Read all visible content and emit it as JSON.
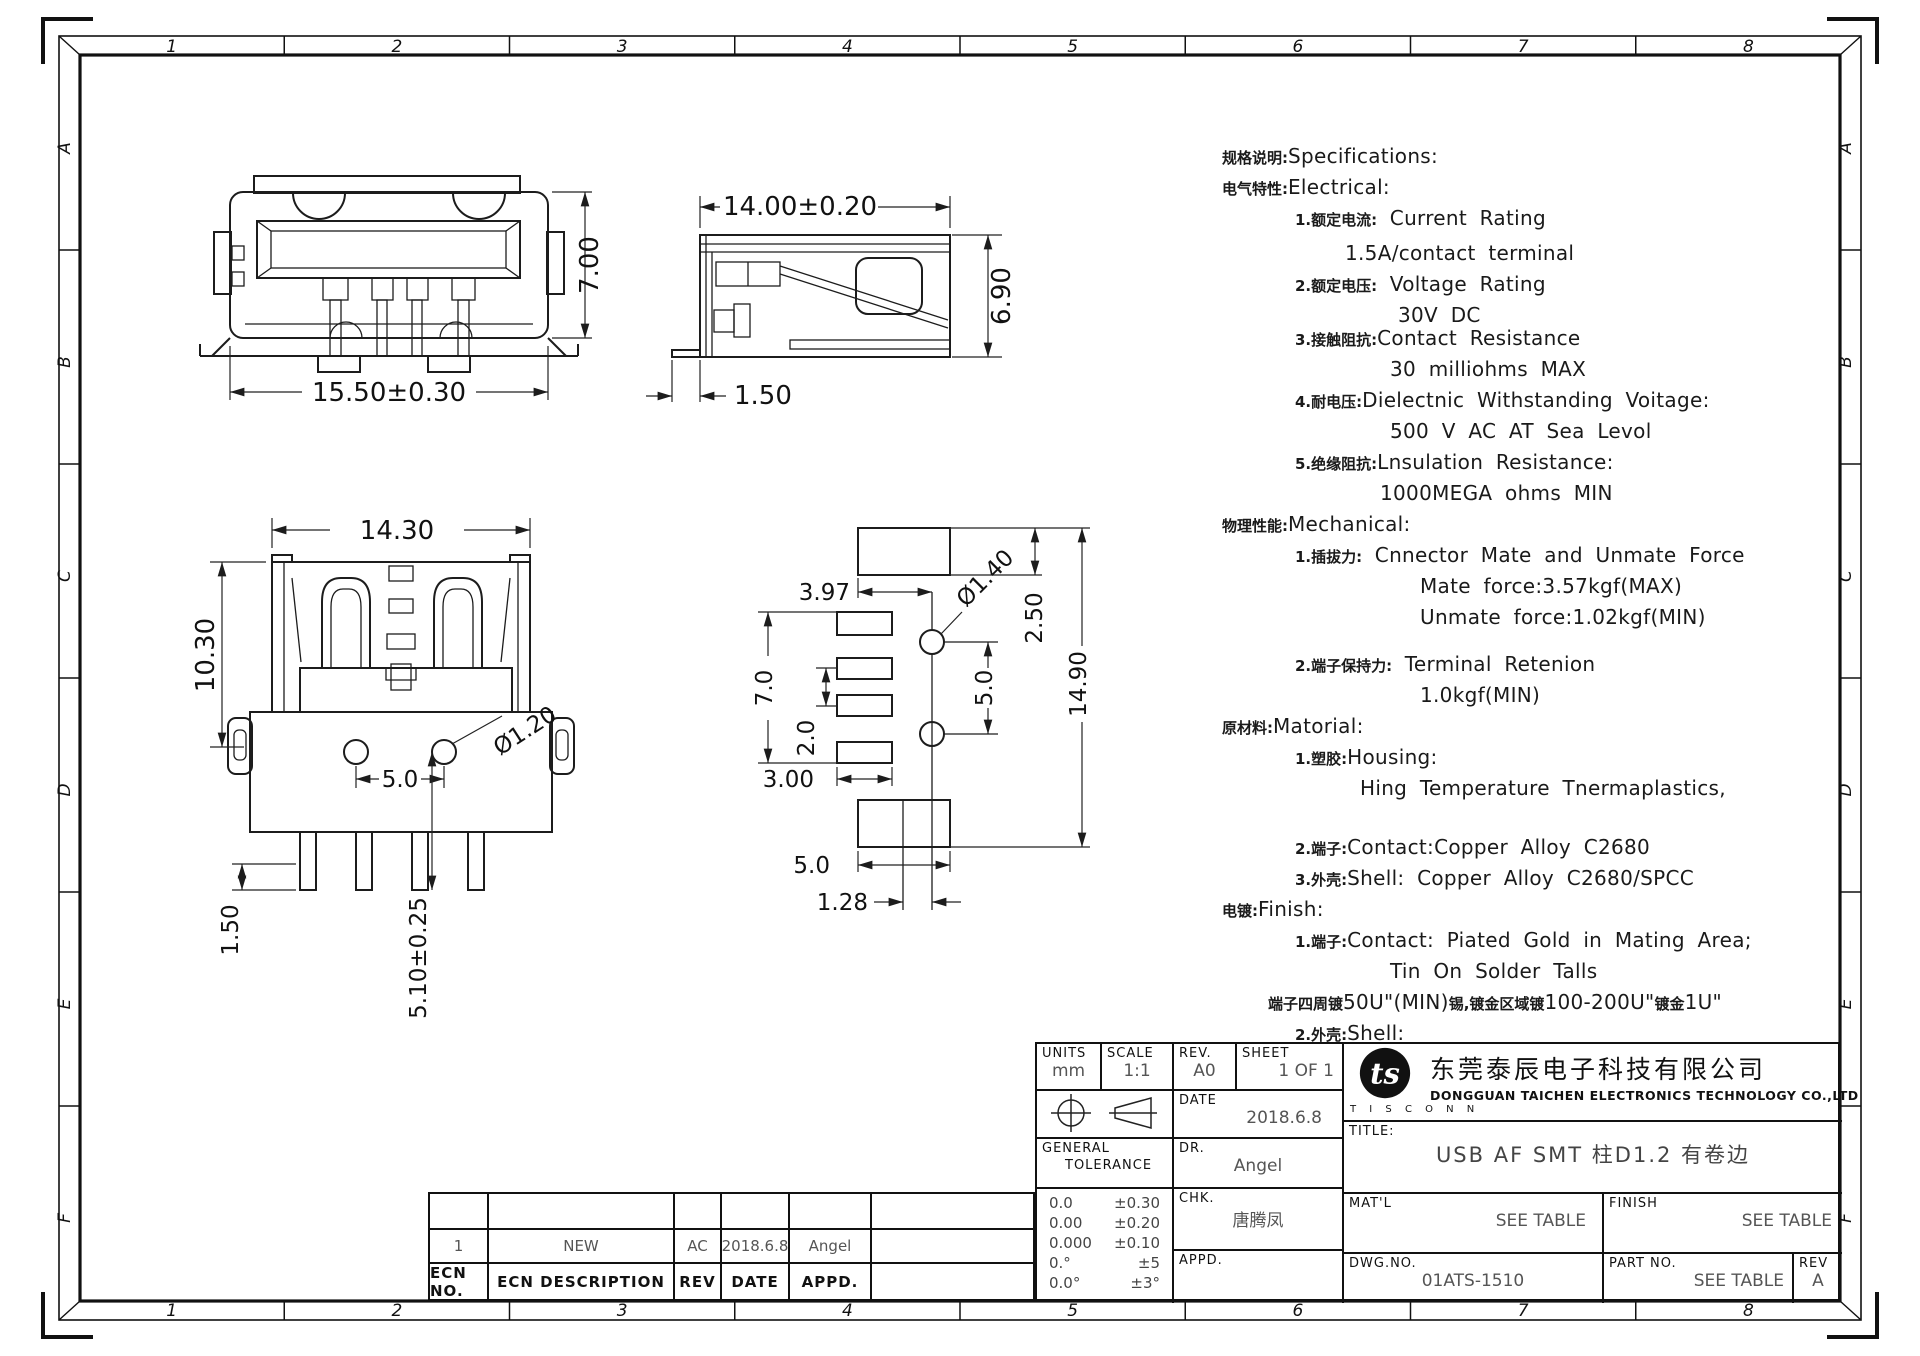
{
  "border": {
    "cols": [
      "1",
      "2",
      "3",
      "4",
      "5",
      "6",
      "7",
      "8"
    ],
    "rows": [
      "A",
      "B",
      "C",
      "D",
      "E",
      "F"
    ]
  },
  "views": {
    "front": {
      "width": "15.50±0.30",
      "height": "7.00"
    },
    "side": {
      "width": "14.00±0.20",
      "height": "6.90",
      "foot": "1.50"
    },
    "bottom": {
      "width": "14.30",
      "height": "10.30",
      "hole": "Ø1.20",
      "pitch": "5.0",
      "leg": "1.50",
      "depth": "5.10±0.25"
    },
    "footprint": {
      "pad_offset": "3.97",
      "pads_span": "7.0",
      "pad_pitch": "2.0",
      "pad_width": "3.00",
      "hole": "Ø1.40",
      "pad_height": "2.50",
      "hole_pitch": "5.0",
      "total_height": "14.90",
      "pad2_width": "5.0",
      "center_offset": "1.28"
    }
  },
  "specs": {
    "lines": [
      {
        "segs": [
          [
            "zh",
            "规格说明:"
          ],
          [
            "en",
            "Specifications:"
          ]
        ],
        "indent": 0,
        "gap": 0
      },
      {
        "segs": [
          [
            "zh",
            "电气特性:"
          ],
          [
            "en",
            "Electrical:"
          ]
        ],
        "indent": 0,
        "gap": 0
      },
      {
        "segs": [
          [
            "zh",
            "1.额定电流:"
          ],
          [
            "en",
            " Current Rating"
          ]
        ],
        "indent": 73,
        "gap": 0
      },
      {
        "segs": [
          [
            "en",
            "1.5A/contact terminal"
          ]
        ],
        "indent": 123,
        "gap": 4
      },
      {
        "segs": [
          [
            "zh",
            "2.额定电压:"
          ],
          [
            "en",
            " Voltage Rating"
          ]
        ],
        "indent": 73,
        "gap": 0
      },
      {
        "segs": [
          [
            "en",
            "30V DC"
          ]
        ],
        "indent": 176,
        "gap": 0
      },
      {
        "segs": [
          [
            "zh",
            "3.接触阻抗:"
          ],
          [
            "en",
            "Contact Resistance"
          ]
        ],
        "indent": 73,
        "gap": -8
      },
      {
        "segs": [
          [
            "en",
            "30 milliohms MAX"
          ]
        ],
        "indent": 168,
        "gap": 0
      },
      {
        "segs": [
          [
            "zh",
            "4.耐电压:"
          ],
          [
            "en",
            "Dielectnic Withstanding Voitage:"
          ]
        ],
        "indent": 73,
        "gap": 0
      },
      {
        "segs": [
          [
            "en",
            "500 V AC AT Sea Levol"
          ]
        ],
        "indent": 168,
        "gap": 0
      },
      {
        "segs": [
          [
            "zh",
            "5.绝缘阻抗:"
          ],
          [
            "en",
            "Lnsulation Resistance:"
          ]
        ],
        "indent": 73,
        "gap": 0
      },
      {
        "segs": [
          [
            "en",
            "1000MEGA ohms MIN"
          ]
        ],
        "indent": 158,
        "gap": 0
      },
      {
        "segs": [
          [
            "zh",
            "物理性能:"
          ],
          [
            "en",
            "Mechanical:"
          ]
        ],
        "indent": 0,
        "gap": 0
      },
      {
        "segs": [
          [
            "zh",
            "1.插拔力:"
          ],
          [
            "en",
            " Cnnector Mate and Unmate Force"
          ]
        ],
        "indent": 73,
        "gap": 0
      },
      {
        "segs": [
          [
            "en",
            "Mate force:3.57kgf(MAX)"
          ]
        ],
        "indent": 198,
        "gap": 0
      },
      {
        "segs": [
          [
            "en",
            "Unmate force:1.02kgf(MIN)"
          ]
        ],
        "indent": 198,
        "gap": 0
      },
      {
        "segs": [
          [
            "zh",
            "2.端子保持力:"
          ],
          [
            "en",
            " Terminal Retenion"
          ]
        ],
        "indent": 73,
        "gap": 16
      },
      {
        "segs": [
          [
            "en",
            "1.0kgf(MIN)"
          ]
        ],
        "indent": 198,
        "gap": 0
      },
      {
        "segs": [
          [
            "zh",
            "原材料:"
          ],
          [
            "en",
            "Matorial:"
          ]
        ],
        "indent": 0,
        "gap": 0
      },
      {
        "segs": [
          [
            "zh",
            "1.塑胶:"
          ],
          [
            "en",
            "Housing:"
          ]
        ],
        "indent": 73,
        "gap": 0
      },
      {
        "segs": [
          [
            "en",
            "Hing Temperature   Tnermaplastics,"
          ]
        ],
        "indent": 138,
        "gap": 0
      },
      {
        "segs": [
          [
            "zh",
            "2.端子:"
          ],
          [
            "en",
            "Contact:Copper Alloy C2680"
          ]
        ],
        "indent": 73,
        "gap": 28
      },
      {
        "segs": [
          [
            "zh",
            "3.外壳:"
          ],
          [
            "en",
            "Shell: Copper Alloy C2680/SPCC"
          ]
        ],
        "indent": 73,
        "gap": 0
      },
      {
        "segs": [
          [
            "zh",
            "电镀:"
          ],
          [
            "en",
            "Finish:"
          ]
        ],
        "indent": 0,
        "gap": 0
      },
      {
        "segs": [
          [
            "zh",
            "1.端子:"
          ],
          [
            "en",
            "Contact: Piated Gold in Mating Area;"
          ]
        ],
        "indent": 73,
        "gap": 0
      },
      {
        "segs": [
          [
            "en",
            "Tin On Solder Talls"
          ]
        ],
        "indent": 168,
        "gap": 0
      },
      {
        "segs": [
          [
            "zh",
            "端子四周镀"
          ],
          [
            "en",
            "50U\"(MIN)"
          ],
          [
            "zh",
            "锡,镀金区域镀"
          ],
          [
            "en",
            "100-200U\""
          ],
          [
            "zh",
            "镀金"
          ],
          [
            "en",
            "1U\""
          ]
        ],
        "indent": 46,
        "gap": 0
      },
      {
        "segs": [
          [
            "zh",
            "2.外壳:"
          ],
          [
            "en",
            "Shell:"
          ]
        ],
        "indent": 73,
        "gap": 0
      },
      {
        "segs": [
          [
            "zh",
            "铜壳四周镀"
          ],
          [
            "en",
            "80U\"(MIN)"
          ],
          [
            "zh",
            "锡"
          ]
        ],
        "indent": 88,
        "gap": 0
      },
      {
        "segs": [
          [
            "en",
            "Nickel Plating"
          ]
        ],
        "indent": 268,
        "gap": 14
      }
    ]
  },
  "title_block": {
    "units_label": "UNITS",
    "units_value": "mm",
    "scale_label": "SCALE",
    "scale_value": "1:1",
    "rev_label": "REV.",
    "rev_value": "A0",
    "sheet_label": "SHEET",
    "sheet_value": "1 OF 1",
    "date_label": "DATE",
    "date_value": "2018.6.8",
    "dr_label": "DR.",
    "dr_value": "Angel",
    "chk_label": "CHK.",
    "chk_value": "唐腾凤",
    "appd_label": "APPD.",
    "appd_value": "",
    "general_tolerance_1": "GENERAL",
    "general_tolerance_2": "TOLERANCE",
    "tolerances": [
      [
        "0.0",
        "±0.30"
      ],
      [
        "0.00",
        "±0.20"
      ],
      [
        "0.000",
        "±0.10"
      ],
      [
        "0.°",
        "±5"
      ],
      [
        "0.0°",
        "±3°"
      ]
    ],
    "company_cn": "东莞泰辰电子科技有限公司",
    "company_en": "DONGGUAN TAICHEN ELECTRONICS TECHNOLOGY CO.,LTD",
    "logo_monogram": "ts",
    "logo_text": "T I S C O N N",
    "title_label": "TITLE:",
    "title_value": "USB AF SMT 柱D1.2 有卷边",
    "matl_label": "MAT'L",
    "matl_value": "SEE TABLE",
    "finish_label": "FINISH",
    "finish_value": "SEE TABLE",
    "dwgno_label": "DWG.NO.",
    "dwgno_value": "01ATS-1510",
    "partno_label": "PART NO.",
    "partno_value": "SEE TABLE",
    "rev2_label": "REV",
    "rev2_value": "A"
  },
  "ecn": {
    "headers": [
      "ECN NO.",
      "ECN DESCRIPTION",
      "REV",
      "DATE",
      "APPD."
    ],
    "rows": [
      [
        "1",
        "NEW",
        "AC",
        "2018.6.8",
        "Angel"
      ]
    ]
  }
}
